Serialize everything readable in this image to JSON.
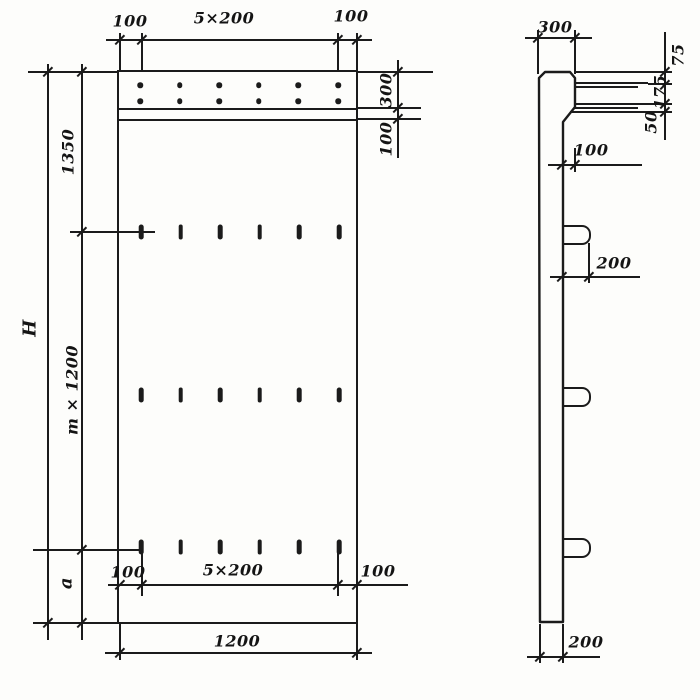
{
  "drawing_type": "precast-wall-panel-dimension-drawing",
  "colors": {
    "ink": "#1b1b1b",
    "paper": "#fdfdfb"
  },
  "front_view": {
    "top_dimensions": {
      "left_margin": "100",
      "spacing": "5×200",
      "right_margin": "100"
    },
    "right_chain": {
      "band_height": "300",
      "band_offset": "100"
    },
    "left_chain": {
      "overall_height": "H",
      "top_segment": "1350",
      "middle_segment": "m × 1200",
      "bottom_segment": "a"
    },
    "bottom_dimensions": {
      "left_margin": "100",
      "spacing": "5×200",
      "right_margin": "100",
      "overall_width": "1200"
    },
    "bolt_grid": {
      "rows": 2,
      "cols": 6
    },
    "slot_grid": {
      "rows": 3,
      "cols": 6
    }
  },
  "side_view": {
    "top_width": "300",
    "right_chain": {
      "top": "75",
      "middle": "175",
      "bottom": "50"
    },
    "step_depth": "100",
    "loop_projection": "200",
    "bottom_width": "200",
    "loop_count": 3
  }
}
